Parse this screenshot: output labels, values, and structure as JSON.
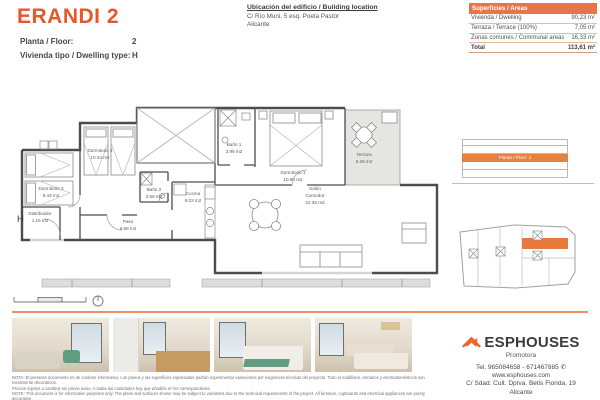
{
  "header": {
    "title": "ERANDI 2",
    "floor_label": "Planta / Floor:",
    "floor_value": "2",
    "type_label": "Vivienda tipo / Dwelling type:",
    "type_value": "H",
    "location_title": "Ubicación del edificio / Building location",
    "location_line1": "C/ Río Muni, 5 esq. Poeta Pastor",
    "location_line2": "Alicante"
  },
  "areas_table": {
    "header": "Superficies / Areas",
    "rows": [
      {
        "label": "Vivienda / Dwelling",
        "value": "90,23 m²"
      },
      {
        "label": "Terraza / Terrace (100%)",
        "value": "7,05 m²"
      },
      {
        "label": "Zonas comunes / Communal areas",
        "value": "16,33 m²"
      }
    ],
    "total_label": "Total",
    "total_value": "113,61 m²"
  },
  "floor_plan": {
    "unit_letter": "H",
    "rooms": [
      {
        "name": "Dormitorio 3",
        "area": "9.43 m2"
      },
      {
        "name": "Distribuidor",
        "area": "1.16 m2"
      },
      {
        "name": "Dormitorio 2",
        "area": "10.34 m2"
      },
      {
        "name": "Baño 2",
        "area": "3.58 m2"
      },
      {
        "name": "Cocina",
        "area": "8.02 m2"
      },
      {
        "name": "Paso",
        "area": "6.68 m2"
      },
      {
        "name": "Baño 1",
        "area": "3.98 m2"
      },
      {
        "name": "Dormitorio 1",
        "area": "10.90 m2"
      },
      {
        "name": "Terraza",
        "area": "6.26 m2"
      },
      {
        "name": "Salón",
        "name2": "Comedor",
        "area": "22.36 m2"
      }
    ]
  },
  "side_panel": {
    "elevation_label": "Planta / Floor: 2"
  },
  "footer": {
    "brand": "ESPHOUSES",
    "brand_sub": "Promotora",
    "phone": "Tel. 965084658 - 671467885",
    "website": "www.esphouses.com",
    "address_line1": "C/ Sdad. Cult. Dptva. Betis Florida, 19",
    "address_line2": "Alicante"
  },
  "disclaimer": {
    "lines": [
      "NOTA: El presente documento es de carácter informativo. Los planos y las superficies expresadas podrán experimentar variaciones por exigencias técnicas del proyecto. Todo el mobiliario, armarios y electrodomésticos son meramente decorativos.",
      "Precios sujetos a cambios sin previo aviso. A todas las cantidades hay que añadirle el IVA correspondiente.",
      "NOTE: This document is for information purposes only. The plans and surfaces shown may be subject to variations due to the technical requirements of the project. All furniture, cupboards and electrical appliances are purely decorative.",
      "Prices subject to change without notice. VAT must be added to all amounts."
    ]
  },
  "colors": {
    "accent": "#e5582a",
    "table_header": "#e8744a",
    "highlight": "#e8793c",
    "divider": "#ec9166"
  }
}
